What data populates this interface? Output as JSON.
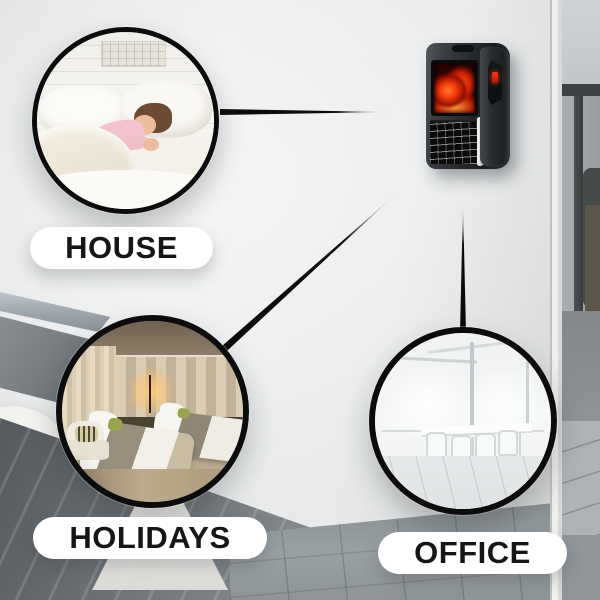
{
  "labels": {
    "house": "HOUSE",
    "holidays": "HOLIDAYS",
    "office": "OFFICE"
  },
  "colors": {
    "connector_line": "#0c0c0c",
    "circle_ring": "#0c0c0c",
    "pill_background": "#ffffff",
    "pill_text": "#161616",
    "flame_accent": "#f03909",
    "heater_led": "#d42010",
    "heater_body": "#26292c",
    "wall": "#e7e9ea"
  }
}
